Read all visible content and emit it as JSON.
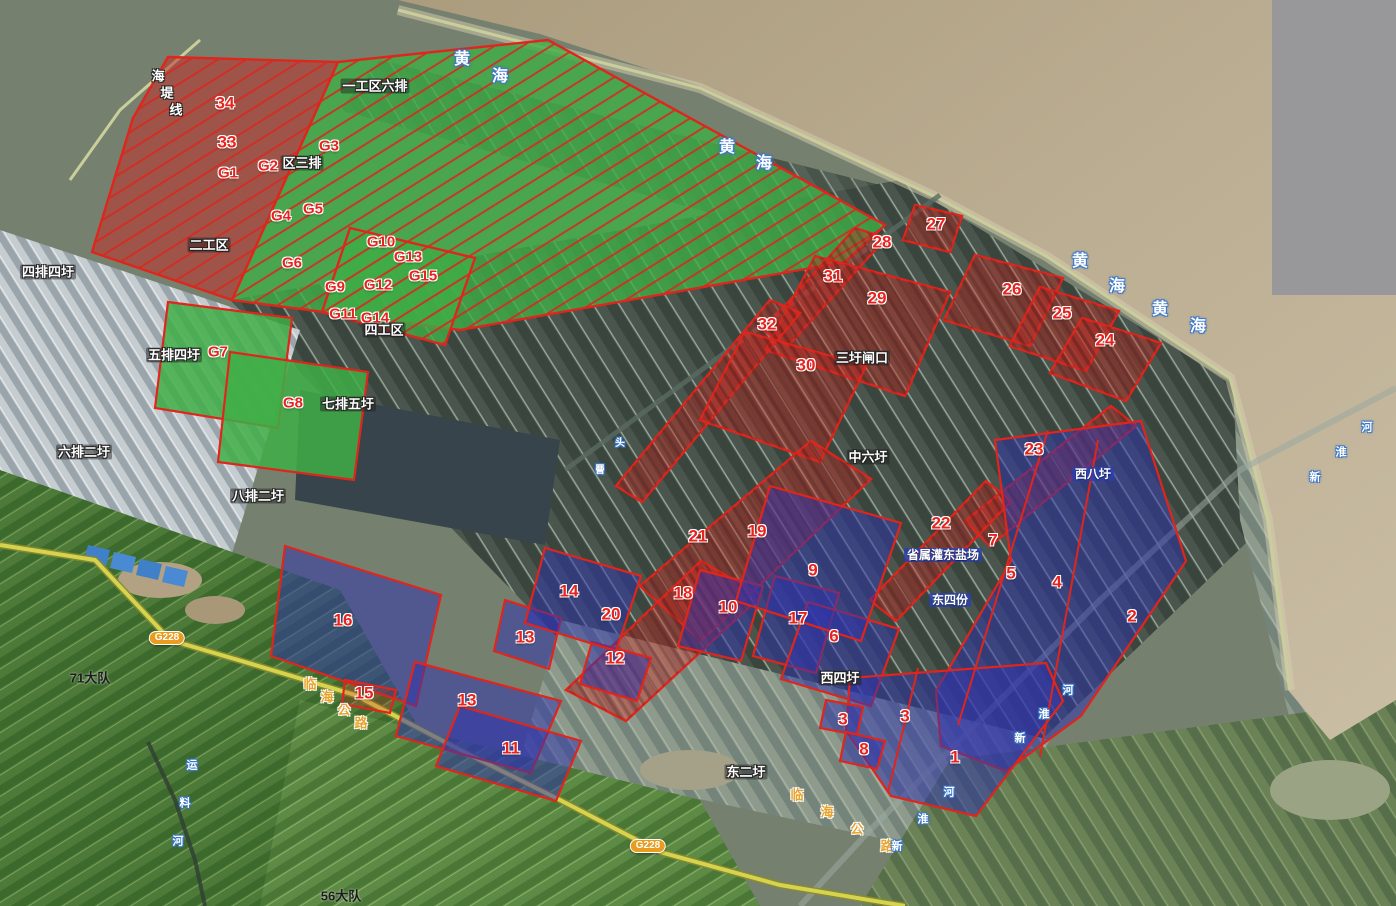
{
  "canvas": {
    "width": 1396,
    "height": 906
  },
  "colors": {
    "parcel_outline": "#e0251c",
    "parcel_number_text": "#e8231d",
    "red_parcel_fill": "rgba(204,42,36,0.42)",
    "blue_parcel_fill": "rgba(47,52,172,0.52)",
    "green_parcel_fill": "#3fae46",
    "sea": "#b5a686",
    "sea_label_outline": "#3c78c8",
    "road_label": "#e8a32c",
    "badge_bg": "#e89c20"
  },
  "map": {
    "parcels": [
      {
        "name": "zone-red-33-34",
        "type": "hatch-red",
        "points": "168,57 338,62 232,300 92,252 133,118"
      },
      {
        "name": "zone-green-gongqu1",
        "type": "hatch-green",
        "points": "338,62 548,40 885,225 845,262 460,330 232,300"
      },
      {
        "name": "zone-green-gongqu4",
        "type": "hatch-green",
        "points": "350,228 475,258 445,345 322,312"
      },
      {
        "name": "parcel-G7",
        "type": "green",
        "points": "168,302 292,318 278,428 155,408"
      },
      {
        "name": "parcel-G8",
        "type": "green",
        "points": "230,352 368,372 354,480 218,462"
      },
      {
        "name": "parcel-27",
        "type": "red",
        "points": "915,205 962,216 950,252 903,240"
      },
      {
        "name": "parcel-28",
        "type": "red",
        "points": "855,228 886,238 788,346 763,330"
      },
      {
        "name": "parcel-29-31",
        "type": "red",
        "points": "815,256 950,292 905,396 766,350"
      },
      {
        "name": "parcel-32",
        "type": "red",
        "points": "770,300 800,313 642,502 616,486"
      },
      {
        "name": "parcel-30",
        "type": "red",
        "points": "745,332 866,366 820,462 700,420"
      },
      {
        "name": "parcel-26",
        "type": "red",
        "points": "975,255 1063,278 1030,346 944,320"
      },
      {
        "name": "parcel-25",
        "type": "red",
        "points": "1040,287 1119,311 1086,371 1010,346"
      },
      {
        "name": "parcel-24",
        "type": "red",
        "points": "1082,318 1161,343 1126,401 1050,373"
      },
      {
        "name": "parcel-23",
        "type": "red",
        "points": "965,521 1111,406 1136,426 990,546"
      },
      {
        "name": "parcel-22",
        "type": "red",
        "points": "870,600 986,481 1011,501 896,621"
      },
      {
        "name": "parcel-21-19",
        "type": "red",
        "points": "640,586 811,441 871,479 701,641"
      },
      {
        "name": "parcel-18-20",
        "type": "red",
        "points": "566,690 701,561 761,596 626,721"
      },
      {
        "name": "parcel-12",
        "type": "blue",
        "points": "592,642 651,658 637,701 580,684"
      },
      {
        "name": "parcel-16",
        "type": "blue",
        "points": "285,546 441,595 416,706 271,656"
      },
      {
        "name": "parcel-15",
        "type": "redline",
        "points": "345,680 396,690 390,713 342,704"
      },
      {
        "name": "parcel-13-small",
        "type": "blue",
        "points": "505,600 561,618 549,669 494,651"
      },
      {
        "name": "parcel-14",
        "type": "blue",
        "points": "545,548 641,576 616,651 525,623"
      },
      {
        "name": "parcel-13-big",
        "type": "blue",
        "points": "415,662 561,701 531,773 396,736"
      },
      {
        "name": "parcel-11",
        "type": "blue",
        "points": "460,706 581,741 556,801 436,766"
      },
      {
        "name": "parcel-10",
        "type": "blue",
        "points": "700,570 763,586 741,661 678,646"
      },
      {
        "name": "parcel-17",
        "type": "blue",
        "points": "775,576 839,593 816,673 753,656"
      },
      {
        "name": "parcel-6",
        "type": "blue",
        "points": "808,602 899,629 871,706 781,679"
      },
      {
        "name": "parcel-9",
        "type": "blue",
        "points": "770,486 901,523 861,641 736,601"
      },
      {
        "name": "parcel-7-5-4-2",
        "type": "blue",
        "points": "995,440 1141,421 1186,561 1081,716 1006,771 941,746 936,691 1011,561"
      },
      {
        "name": "parcel-1-3",
        "type": "blue",
        "points": "850,678 1046,663 1063,701 976,816 891,796 846,731"
      },
      {
        "name": "parcel-3-left",
        "type": "blue",
        "points": "826,700 863,707 857,735 820,728"
      },
      {
        "name": "parcel-8",
        "type": "blue",
        "points": "846,732 885,741 877,769 840,761"
      }
    ],
    "red_lines": [
      {
        "x1": 1048,
        "y1": 430,
        "x2": 958,
        "y2": 725
      },
      {
        "x1": 1098,
        "y1": 440,
        "x2": 1040,
        "y2": 757
      },
      {
        "x1": 918,
        "y1": 668,
        "x2": 888,
        "y2": 792
      }
    ],
    "labels": [
      {
        "name": "parcel-label-34",
        "text": "34",
        "x": 225,
        "y": 103,
        "type": "parcel-red",
        "interactable": true
      },
      {
        "name": "parcel-label-33",
        "text": "33",
        "x": 227,
        "y": 142,
        "type": "parcel-red",
        "interactable": true
      },
      {
        "name": "parcel-label-G1",
        "text": "G1",
        "x": 228,
        "y": 173,
        "type": "parcel-red sz15",
        "interactable": true
      },
      {
        "name": "parcel-label-G2",
        "text": "G2",
        "x": 268,
        "y": 166,
        "type": "parcel-red sz15",
        "interactable": true
      },
      {
        "name": "parcel-label-G3",
        "text": "G3",
        "x": 329,
        "y": 146,
        "type": "parcel-red sz15",
        "interactable": true
      },
      {
        "name": "parcel-label-G4",
        "text": "G4",
        "x": 281,
        "y": 216,
        "type": "parcel-red sz15",
        "interactable": true
      },
      {
        "name": "parcel-label-G5",
        "text": "G5",
        "x": 313,
        "y": 209,
        "type": "parcel-red sz15",
        "interactable": true
      },
      {
        "name": "parcel-label-G6",
        "text": "G6",
        "x": 292,
        "y": 263,
        "type": "parcel-red sz15",
        "interactable": true
      },
      {
        "name": "parcel-label-G9",
        "text": "G9",
        "x": 335,
        "y": 287,
        "type": "parcel-red sz15",
        "interactable": true
      },
      {
        "name": "parcel-label-G10",
        "text": "G10",
        "x": 381,
        "y": 242,
        "type": "parcel-red sz15",
        "interactable": true
      },
      {
        "name": "parcel-label-G12",
        "text": "G12",
        "x": 378,
        "y": 285,
        "type": "parcel-red sz15",
        "interactable": true
      },
      {
        "name": "parcel-label-G13",
        "text": "G13",
        "x": 408,
        "y": 257,
        "type": "parcel-red sz15",
        "interactable": true
      },
      {
        "name": "parcel-label-G15",
        "text": "G15",
        "x": 423,
        "y": 276,
        "type": "parcel-red sz15",
        "interactable": true
      },
      {
        "name": "parcel-label-G11",
        "text": "G11",
        "x": 343,
        "y": 314,
        "type": "parcel-red sz15",
        "interactable": true
      },
      {
        "name": "parcel-label-G14",
        "text": "G14",
        "x": 375,
        "y": 318,
        "type": "parcel-red sz15",
        "interactable": true
      },
      {
        "name": "parcel-label-G7",
        "text": "G7",
        "x": 218,
        "y": 352,
        "type": "parcel-red sz15",
        "interactable": true
      },
      {
        "name": "parcel-label-G8",
        "text": "G8",
        "x": 293,
        "y": 403,
        "type": "parcel-red sz15",
        "interactable": true
      },
      {
        "name": "parcel-label-27",
        "text": "27",
        "x": 936,
        "y": 224,
        "type": "parcel-red",
        "interactable": true
      },
      {
        "name": "parcel-label-28",
        "text": "28",
        "x": 882,
        "y": 242,
        "type": "parcel-red",
        "interactable": true
      },
      {
        "name": "parcel-label-31",
        "text": "31",
        "x": 833,
        "y": 276,
        "type": "parcel-red",
        "interactable": true
      },
      {
        "name": "parcel-label-29",
        "text": "29",
        "x": 877,
        "y": 298,
        "type": "parcel-red",
        "interactable": true
      },
      {
        "name": "parcel-label-26",
        "text": "26",
        "x": 1012,
        "y": 289,
        "type": "parcel-red",
        "interactable": true
      },
      {
        "name": "parcel-label-25",
        "text": "25",
        "x": 1062,
        "y": 313,
        "type": "parcel-red",
        "interactable": true
      },
      {
        "name": "parcel-label-24",
        "text": "24",
        "x": 1105,
        "y": 340,
        "type": "parcel-red",
        "interactable": true
      },
      {
        "name": "parcel-label-32",
        "text": "32",
        "x": 767,
        "y": 324,
        "type": "parcel-red",
        "interactable": true
      },
      {
        "name": "parcel-label-30",
        "text": "30",
        "x": 806,
        "y": 365,
        "type": "parcel-red",
        "interactable": true
      },
      {
        "name": "parcel-label-23",
        "text": "23",
        "x": 1034,
        "y": 449,
        "type": "parcel-red",
        "interactable": true
      },
      {
        "name": "parcel-label-22",
        "text": "22",
        "x": 941,
        "y": 523,
        "type": "parcel-red",
        "interactable": true
      },
      {
        "name": "parcel-label-21",
        "text": "21",
        "x": 698,
        "y": 536,
        "type": "parcel-red",
        "interactable": true
      },
      {
        "name": "parcel-label-19",
        "text": "19",
        "x": 757,
        "y": 531,
        "type": "parcel-red",
        "interactable": true
      },
      {
        "name": "parcel-label-18",
        "text": "18",
        "x": 683,
        "y": 593,
        "type": "parcel-red",
        "interactable": true
      },
      {
        "name": "parcel-label-20",
        "text": "20",
        "x": 611,
        "y": 614,
        "type": "parcel-red",
        "interactable": true
      },
      {
        "name": "parcel-label-12",
        "text": "12",
        "x": 615,
        "y": 658,
        "type": "parcel-red",
        "interactable": true
      },
      {
        "name": "parcel-label-14",
        "text": "14",
        "x": 569,
        "y": 591,
        "type": "parcel-red",
        "interactable": true
      },
      {
        "name": "parcel-label-13a",
        "text": "13",
        "x": 525,
        "y": 637,
        "type": "parcel-red",
        "interactable": true
      },
      {
        "name": "parcel-label-13b",
        "text": "13",
        "x": 467,
        "y": 700,
        "type": "parcel-red",
        "interactable": true
      },
      {
        "name": "parcel-label-16",
        "text": "16",
        "x": 343,
        "y": 620,
        "type": "parcel-red",
        "interactable": true
      },
      {
        "name": "parcel-label-15",
        "text": "15",
        "x": 364,
        "y": 693,
        "type": "parcel-red",
        "interactable": true
      },
      {
        "name": "parcel-label-11",
        "text": "11",
        "x": 511,
        "y": 748,
        "type": "parcel-red",
        "interactable": true
      },
      {
        "name": "parcel-label-10",
        "text": "10",
        "x": 728,
        "y": 607,
        "type": "parcel-red",
        "interactable": true
      },
      {
        "name": "parcel-label-17",
        "text": "17",
        "x": 798,
        "y": 618,
        "type": "parcel-red",
        "interactable": true
      },
      {
        "name": "parcel-label-9",
        "text": "9",
        "x": 813,
        "y": 570,
        "type": "parcel-red",
        "interactable": true
      },
      {
        "name": "parcel-label-6",
        "text": "6",
        "x": 834,
        "y": 636,
        "type": "parcel-red",
        "interactable": true
      },
      {
        "name": "parcel-label-7",
        "text": "7",
        "x": 993,
        "y": 540,
        "type": "parcel-red",
        "interactable": true
      },
      {
        "name": "parcel-label-5",
        "text": "5",
        "x": 1011,
        "y": 573,
        "type": "parcel-red",
        "interactable": true
      },
      {
        "name": "parcel-label-4",
        "text": "4",
        "x": 1057,
        "y": 582,
        "type": "parcel-red",
        "interactable": true
      },
      {
        "name": "parcel-label-2",
        "text": "2",
        "x": 1132,
        "y": 616,
        "type": "parcel-red",
        "interactable": true
      },
      {
        "name": "parcel-label-3a",
        "text": "3",
        "x": 843,
        "y": 719,
        "type": "parcel-red",
        "interactable": true
      },
      {
        "name": "parcel-label-3b",
        "text": "3",
        "x": 905,
        "y": 716,
        "type": "parcel-red",
        "interactable": true
      },
      {
        "name": "parcel-label-8",
        "text": "8",
        "x": 864,
        "y": 749,
        "type": "parcel-red",
        "interactable": true
      },
      {
        "name": "parcel-label-1",
        "text": "1",
        "x": 955,
        "y": 757,
        "type": "parcel-red",
        "interactable": true
      },
      {
        "name": "place-yigongqu-liupai",
        "text": "一工区六排",
        "x": 375,
        "y": 86,
        "type": "place-dark",
        "interactable": false
      },
      {
        "name": "place-qusanpai",
        "text": "区三排",
        "x": 302,
        "y": 163,
        "type": "place-dark",
        "interactable": false
      },
      {
        "name": "place-ergongqu",
        "text": "二工区",
        "x": 209,
        "y": 245,
        "type": "place-dark",
        "interactable": false
      },
      {
        "name": "place-sigongqu",
        "text": "四工区",
        "x": 384,
        "y": 330,
        "type": "place-dark",
        "interactable": false
      },
      {
        "name": "place-sipaisiwei",
        "text": "四排四圩",
        "x": 48,
        "y": 272,
        "type": "place-dark",
        "interactable": false
      },
      {
        "name": "place-wupaisiwei",
        "text": "五排四圩",
        "x": 174,
        "y": 355,
        "type": "place-dark",
        "interactable": false
      },
      {
        "name": "place-qipaiwuwei",
        "text": "七排五圩",
        "x": 348,
        "y": 404,
        "type": "place-dark",
        "interactable": false
      },
      {
        "name": "place-liupaierwei",
        "text": "六排二圩",
        "x": 84,
        "y": 452,
        "type": "place-dark",
        "interactable": false
      },
      {
        "name": "place-bapaierwei",
        "text": "八排二圩",
        "x": 258,
        "y": 496,
        "type": "place-dark",
        "interactable": false
      },
      {
        "name": "place-sanweizhakou",
        "text": "三圩闸口",
        "x": 862,
        "y": 358,
        "type": "place-dark",
        "interactable": false
      },
      {
        "name": "place-zhongliuwei",
        "text": "中六圩",
        "x": 868,
        "y": 457,
        "type": "place-dark",
        "interactable": false
      },
      {
        "name": "place-xisiwei",
        "text": "西四圩",
        "x": 840,
        "y": 678,
        "type": "place-dark",
        "interactable": false
      },
      {
        "name": "place-dongerwei",
        "text": "东二圩",
        "x": 746,
        "y": 772,
        "type": "place-dark",
        "interactable": false
      },
      {
        "name": "place-xibawei",
        "text": "西八圩",
        "x": 1093,
        "y": 474,
        "type": "place-blue",
        "interactable": false
      },
      {
        "name": "place-shengshu-guandong-yanchang",
        "text": "省属灌东盐场",
        "x": 943,
        "y": 555,
        "type": "place-blue",
        "interactable": false
      },
      {
        "name": "place-dongsifen",
        "text": "东四份",
        "x": 950,
        "y": 600,
        "type": "place-blue",
        "interactable": false
      },
      {
        "name": "place-71-dadui",
        "text": "71大队",
        "x": 90,
        "y": 678,
        "type": "place-black",
        "interactable": false
      },
      {
        "name": "place-56-dadui",
        "text": "56大队",
        "x": 341,
        "y": 896,
        "type": "place-black",
        "interactable": false
      },
      {
        "name": "road-badge-g228-a",
        "text": "G228",
        "x": 167,
        "y": 638,
        "type": "road-badge",
        "interactable": false
      },
      {
        "name": "road-badge-g228-b",
        "text": "G228",
        "x": 648,
        "y": 846,
        "type": "road-badge",
        "interactable": false
      },
      {
        "name": "place-haidixian",
        "text": "海堤线",
        "x": 158,
        "y": 76,
        "type": "place-dark stepped",
        "step": {
          "dx": 9,
          "dy": 17
        },
        "interactable": false
      },
      {
        "name": "road-linhai-gonglu-a",
        "text": "临海公路",
        "x": 310,
        "y": 684,
        "type": "road-yellow stepped",
        "step": {
          "dx": 17,
          "dy": 13
        },
        "interactable": false
      },
      {
        "name": "road-linhai-gonglu-b",
        "text": "临海公路",
        "x": 797,
        "y": 795,
        "type": "road-yellow stepped",
        "step": {
          "dx": 30,
          "dy": 17
        },
        "interactable": false
      },
      {
        "name": "sea-huanghai-1",
        "text": "黄海",
        "x": 462,
        "y": 60,
        "type": "sea-blue sz16 stepped",
        "step": {
          "dx": 38,
          "dy": 17
        },
        "interactable": false
      },
      {
        "name": "sea-huanghai-2",
        "text": "黄海",
        "x": 727,
        "y": 148,
        "type": "sea-blue sz16 stepped",
        "step": {
          "dx": 37,
          "dy": 16
        },
        "interactable": false
      },
      {
        "name": "sea-huanghai-3",
        "text": "黄海",
        "x": 1080,
        "y": 262,
        "type": "sea-blue sz16 stepped",
        "step": {
          "dx": 37,
          "dy": 25
        },
        "interactable": false
      },
      {
        "name": "sea-huanghai-4",
        "text": "黄海",
        "x": 1160,
        "y": 310,
        "type": "sea-blue sz16 stepped",
        "step": {
          "dx": 38,
          "dy": 17
        },
        "interactable": false
      },
      {
        "name": "river-xinhuaihe-1",
        "text": "新淮河",
        "x": 1315,
        "y": 478,
        "type": "sea-blue sz11 stepped",
        "step": {
          "dx": 26,
          "dy": -25
        },
        "interactable": false
      },
      {
        "name": "river-xinhuaihe-2",
        "text": "新淮河",
        "x": 1020,
        "y": 739,
        "type": "sea-blue sz11 stepped",
        "step": {
          "dx": 24,
          "dy": -24
        },
        "interactable": false
      },
      {
        "name": "river-xinhuaihe-3",
        "text": "新淮河",
        "x": 897,
        "y": 847,
        "type": "sea-blue sz11 stepped",
        "step": {
          "dx": 26,
          "dy": -27
        },
        "interactable": false
      },
      {
        "name": "river-yunliaohe",
        "text": "运料河",
        "x": 192,
        "y": 766,
        "type": "sea-blue sz11 stepped",
        "step": {
          "dx": -7,
          "dy": 38
        },
        "interactable": false
      },
      {
        "name": "place-touzeng",
        "text": "头罾",
        "x": 620,
        "y": 444,
        "type": "sea-blue sz10 stepped",
        "step": {
          "dx": -20,
          "dy": 27
        },
        "interactable": false
      }
    ]
  }
}
